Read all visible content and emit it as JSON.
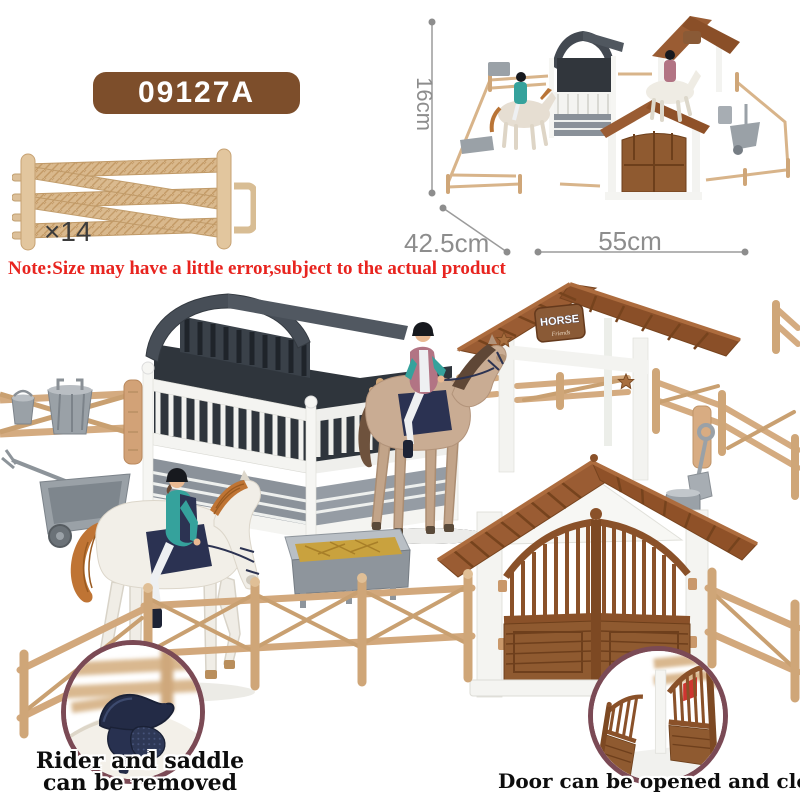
{
  "product": {
    "code": "09127A"
  },
  "fence_sample": {
    "count_label": "×14"
  },
  "note": {
    "text": "Note:Size may have a little error,subject to the actual product"
  },
  "dimensions": {
    "height": "16cm",
    "depth": "42.5cm",
    "width": "55cm"
  },
  "shelter_sign": {
    "title": "HORSE",
    "subtitle": "Friends"
  },
  "insets": {
    "saddle": {
      "caption_line1": "Rider and saddle",
      "caption_line2": "can be removed"
    },
    "door": {
      "caption": "Door can be opened and closed"
    }
  },
  "colors": {
    "badge_brown": "#7d4e2b",
    "note_red": "#e8241f",
    "dimension_gray": "#8d8d8d",
    "fence_tan": "#d4ab80",
    "stable_roof_gray": "#474e57",
    "building_roof_brown": "#9a5c33",
    "gate_brown": "#8f5a30",
    "inset_border_maroon": "#7b4a55",
    "rider_teal": "#35a29c",
    "saddle_navy": "#232b46",
    "hay_yellow": "#c9a23e"
  }
}
